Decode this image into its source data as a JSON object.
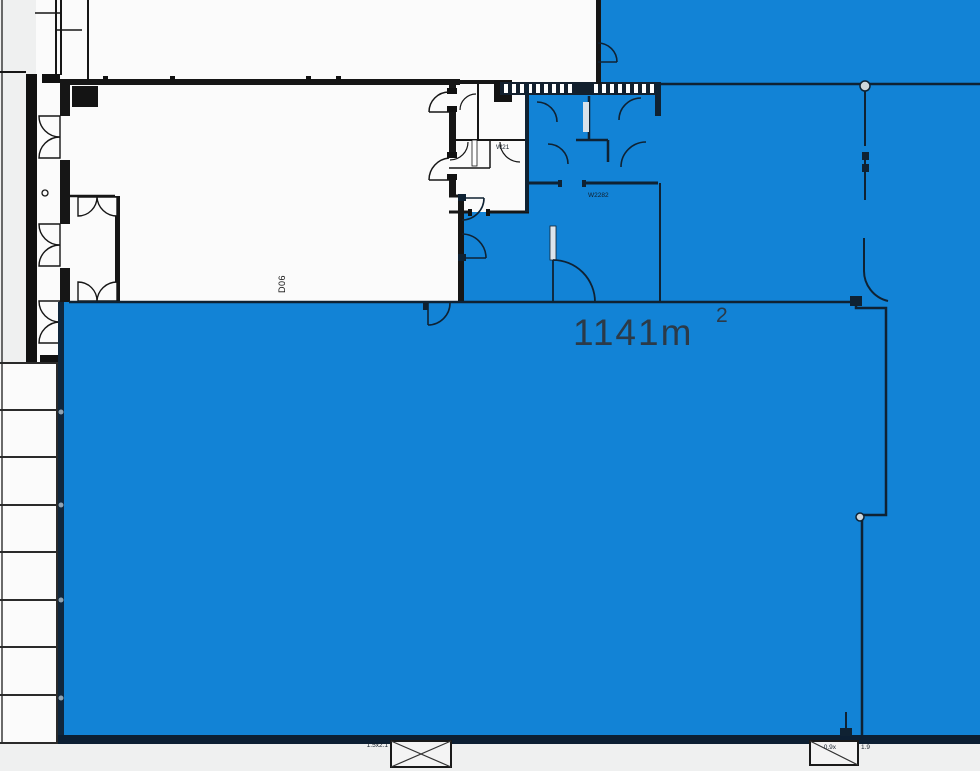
{
  "plan": {
    "area_label": {
      "value": "1141m",
      "exponent": "2"
    },
    "door_label": "D06",
    "room_codes": {
      "white_wc": "W21",
      "blue_wc": "W2282"
    },
    "window_labels": {
      "left": "1.5x2.1",
      "right_inner": "0.9x",
      "right_outer": "1.9"
    },
    "colors": {
      "highlight_blue": "#1283d6",
      "wall_black": "#161616",
      "wall_on_blue": "#0f2233",
      "background": "#eff0f0",
      "room_white": "#fbfbfb"
    }
  }
}
